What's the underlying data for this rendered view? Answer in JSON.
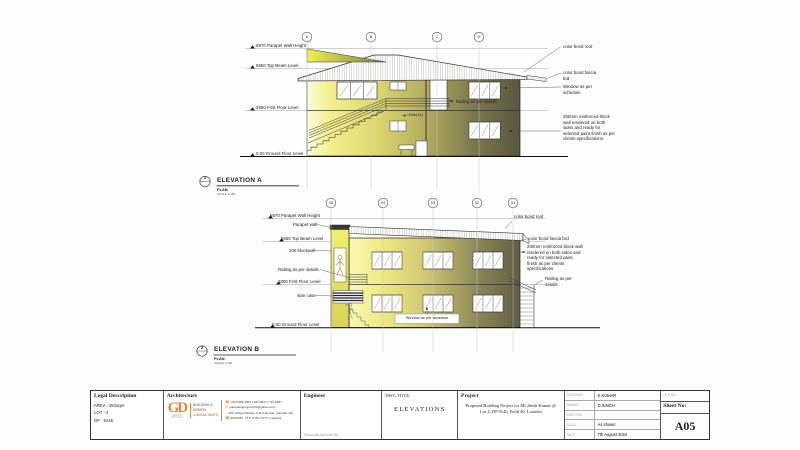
{
  "colors": {
    "accent_orange": "#e2873f",
    "building_light": "#f4f08f",
    "building_dark": "#5a573f",
    "grid_line": "#b9cbd8",
    "meta_label": "#97a5b5"
  },
  "elev_a": {
    "ref_number": "1",
    "title": "ELEVATION A",
    "plan_label": "PLAN",
    "scale_label": "SCALE 1:100",
    "grids": [
      "A",
      "B",
      "C",
      "D"
    ],
    "levels": {
      "parapet": "6970 Parapet Wall Height",
      "top_beam": "5650 Top Beam Level",
      "first_floor": "2800 First Floor Level",
      "ground": "0.00 Ground Floor Level"
    },
    "notes": {
      "roof": "color bond roof",
      "fascia": "color bond fascia brd",
      "window": "Window as per schedule",
      "wall": "200mm reinforced block wall rendered on both sides and ready for selected paint finish as per clients specifications",
      "railing": "Railing as per details",
      "downpipe": "100dia Dp"
    }
  },
  "elev_b": {
    "ref_number": "2",
    "title": "ELEVATION B",
    "plan_label": "PLAN",
    "scale_label": "SCALE 1:100",
    "grids": [
      "05",
      "04",
      "03",
      "02",
      "01"
    ],
    "levels": {
      "parapet": "6970 Parapet Wall Height",
      "top_beam": "5650 Top Beam Level",
      "first_floor": "2800 First Floor Level",
      "ground": "0.00 Ground Floor Level"
    },
    "notes": {
      "parapet_wall": "Parapet wall",
      "blockwall": "200 blockwall",
      "railing_left": "Railing as per details",
      "stair_case": "stair case",
      "roof": "color bond roof",
      "fascia": "color bond fascia brd",
      "wall": "200mm reinforced block wall rendered on both sides and ready for selected paint finish as per clients specifications",
      "railing_right": "Railing as per details",
      "window": "Window as per schedule"
    }
  },
  "title_block": {
    "legal": {
      "header": "Legal Description",
      "area": "AREA : 352sqm",
      "lot": "LOT : 4",
      "dp": "DP : 9145"
    },
    "architecture": {
      "header": "Architecture",
      "logo_mark": "GD",
      "logo_sub": "GRACE DESIGN",
      "tag_line1": "BUILDING &",
      "tag_line2": "DESIGN",
      "tag_line3": "CONSULTANTS",
      "phone": "+679 999 9457 | 921 0937 | 721 0937",
      "email": "gracedesigngroup70@yahoo.com",
      "address": "191 Village Parade, A.N.Z Arcade, Lautoka, Fiji",
      "phone2": "999 9457",
      "po_box": "P O Box 5777, Lautoka"
    },
    "engineer": {
      "header": "Engineer",
      "approved_by": "Structurals Approved By:"
    },
    "dwg": {
      "label": "DWG TITLE:",
      "title": "ELEVATIONS"
    },
    "project": {
      "header": "Project",
      "description": "Proposed Building Project for Mr Jitesh Kumar @ Lot 4, DP 9145, Feild 40, Lautoka"
    },
    "meta": {
      "rows": [
        {
          "label": "DESIGNED",
          "value": "K.KUMAR"
        },
        {
          "label": "DRAWN",
          "value": "D.SINGH"
        },
        {
          "label": "CHECKED",
          "value": ""
        },
        {
          "label": "SCALE",
          "value": "As shown"
        },
        {
          "label": "DATE",
          "value": "7th August 2024"
        }
      ]
    },
    "sheet_box": {
      "file_label": "FILE NO:",
      "sheet_label": "Sheet No:",
      "sheet_value": "A05"
    }
  }
}
